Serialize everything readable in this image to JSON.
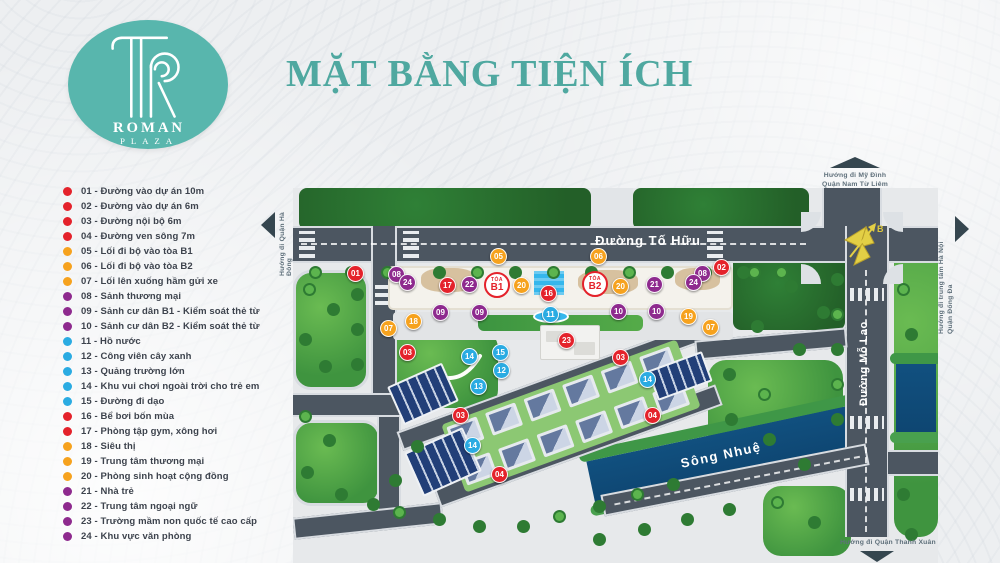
{
  "brand": {
    "line1": "ROMAN",
    "line2": "PLAZA"
  },
  "title": "MẶT BẰNG TIỆN ÍCH",
  "colors": {
    "red": "#e4222b",
    "orange": "#f6a21e",
    "purple": "#8e2a8e",
    "blue": "#2aabe2",
    "teal": "#4fa8a0",
    "road": "#4c5661",
    "river": "#0e4f85"
  },
  "legend": {
    "items": [
      {
        "num": "01",
        "label": "Đường vào dự án 10m",
        "group": "red"
      },
      {
        "num": "02",
        "label": "Đường vào dự án 6m",
        "group": "red"
      },
      {
        "num": "03",
        "label": "Đường nội bộ 6m",
        "group": "red"
      },
      {
        "num": "04",
        "label": "Đường ven sông 7m",
        "group": "red"
      },
      {
        "num": "05",
        "label": "Lối đi bộ vào tòa B1",
        "group": "orange"
      },
      {
        "num": "06",
        "label": "Lối đi bộ vào tòa B2",
        "group": "orange"
      },
      {
        "num": "07",
        "label": "Lối lên xuống hầm gửi xe",
        "group": "orange"
      },
      {
        "num": "08",
        "label": "Sảnh thương mại",
        "group": "purple"
      },
      {
        "num": "09",
        "label": "Sảnh cư dân B1 - Kiểm soát thẻ từ",
        "group": "purple"
      },
      {
        "num": "10",
        "label": "Sảnh cư dân B2 - Kiểm soát thẻ từ",
        "group": "purple"
      },
      {
        "num": "11",
        "label": "Hồ nước",
        "group": "blue"
      },
      {
        "num": "12",
        "label": "Công viên cây xanh",
        "group": "blue"
      },
      {
        "num": "13",
        "label": "Quảng trường lớn",
        "group": "blue"
      },
      {
        "num": "14",
        "label": "Khu vui chơi ngoài trời cho trẻ em",
        "group": "blue"
      },
      {
        "num": "15",
        "label": "Đường đi dạo",
        "group": "blue"
      },
      {
        "num": "16",
        "label": "Bể bơi bốn mùa",
        "group": "red"
      },
      {
        "num": "17",
        "label": "Phòng tập gym, xông hơi",
        "group": "red"
      },
      {
        "num": "18",
        "label": "Siêu thị",
        "group": "orange"
      },
      {
        "num": "19",
        "label": "Trung tâm thương mại",
        "group": "orange"
      },
      {
        "num": "20",
        "label": "Phòng sinh hoạt cộng đồng",
        "group": "orange"
      },
      {
        "num": "21",
        "label": "Nhà trẻ",
        "group": "purple"
      },
      {
        "num": "22",
        "label": "Trung tâm ngoại ngữ",
        "group": "purple"
      },
      {
        "num": "23",
        "label": "Trường mầm non quốc tế cao cấp",
        "group": "purple"
      },
      {
        "num": "24",
        "label": "Khu vực văn phòng",
        "group": "purple"
      }
    ]
  },
  "map": {
    "roads": {
      "to_huu": "Đường Tố Hữu",
      "mo_lao": "Đường Mỗ Lao"
    },
    "river": "Sông Nhuệ",
    "compass": "B",
    "towers": [
      {
        "prefix": "TÒA",
        "name": "B1"
      },
      {
        "prefix": "TÒA",
        "name": "B2"
      }
    ],
    "directions": {
      "west": "Hướng đi Quận Hà Đông",
      "north": [
        "Hướng đi Mỹ Đình",
        "Quận Nam Từ Liêm"
      ],
      "east": [
        "Hướng đi trung tâm Hà Nội",
        "Quận Đống Đa"
      ],
      "south": "Hướng đi Quận Thanh Xuân"
    },
    "markers": [
      {
        "n": "01",
        "group": "red",
        "x": 62,
        "y": 85
      },
      {
        "n": "02",
        "group": "red",
        "x": 428,
        "y": 79
      },
      {
        "n": "03",
        "group": "red",
        "x": 114,
        "y": 164
      },
      {
        "n": "03",
        "group": "red",
        "x": 167,
        "y": 227
      },
      {
        "n": "03",
        "group": "red",
        "x": 327,
        "y": 169
      },
      {
        "n": "04",
        "group": "red",
        "x": 206,
        "y": 286
      },
      {
        "n": "04",
        "group": "red",
        "x": 359,
        "y": 227
      },
      {
        "n": "05",
        "group": "orange",
        "x": 205,
        "y": 68
      },
      {
        "n": "06",
        "group": "orange",
        "x": 305,
        "y": 68
      },
      {
        "n": "07",
        "group": "orange",
        "x": 95,
        "y": 140
      },
      {
        "n": "07",
        "group": "orange",
        "x": 417,
        "y": 139
      },
      {
        "n": "08",
        "group": "purple",
        "x": 103,
        "y": 86
      },
      {
        "n": "08",
        "group": "purple",
        "x": 409,
        "y": 85
      },
      {
        "n": "09",
        "group": "purple",
        "x": 147,
        "y": 124
      },
      {
        "n": "09",
        "group": "purple",
        "x": 186,
        "y": 124
      },
      {
        "n": "10",
        "group": "purple",
        "x": 325,
        "y": 123
      },
      {
        "n": "10",
        "group": "purple",
        "x": 363,
        "y": 123
      },
      {
        "n": "11",
        "group": "blue",
        "x": 257,
        "y": 126
      },
      {
        "n": "12",
        "group": "blue",
        "x": 208,
        "y": 182
      },
      {
        "n": "13",
        "group": "blue",
        "x": 185,
        "y": 198
      },
      {
        "n": "14",
        "group": "blue",
        "x": 176,
        "y": 168
      },
      {
        "n": "14",
        "group": "blue",
        "x": 354,
        "y": 191
      },
      {
        "n": "14",
        "group": "blue",
        "x": 179,
        "y": 257
      },
      {
        "n": "15",
        "group": "blue",
        "x": 207,
        "y": 164
      },
      {
        "n": "16",
        "group": "red",
        "x": 255,
        "y": 105
      },
      {
        "n": "17",
        "group": "red",
        "x": 154,
        "y": 97
      },
      {
        "n": "18",
        "group": "orange",
        "x": 120,
        "y": 133
      },
      {
        "n": "19",
        "group": "orange",
        "x": 395,
        "y": 128
      },
      {
        "n": "20",
        "group": "orange",
        "x": 228,
        "y": 97
      },
      {
        "n": "20",
        "group": "orange",
        "x": 327,
        "y": 98
      },
      {
        "n": "21",
        "group": "purple",
        "x": 361,
        "y": 96
      },
      {
        "n": "22",
        "group": "purple",
        "x": 176,
        "y": 96
      },
      {
        "n": "23",
        "group": "red",
        "x": 273,
        "y": 152
      },
      {
        "n": "24",
        "group": "purple",
        "x": 114,
        "y": 94
      },
      {
        "n": "24",
        "group": "purple",
        "x": 400,
        "y": 94
      }
    ]
  }
}
